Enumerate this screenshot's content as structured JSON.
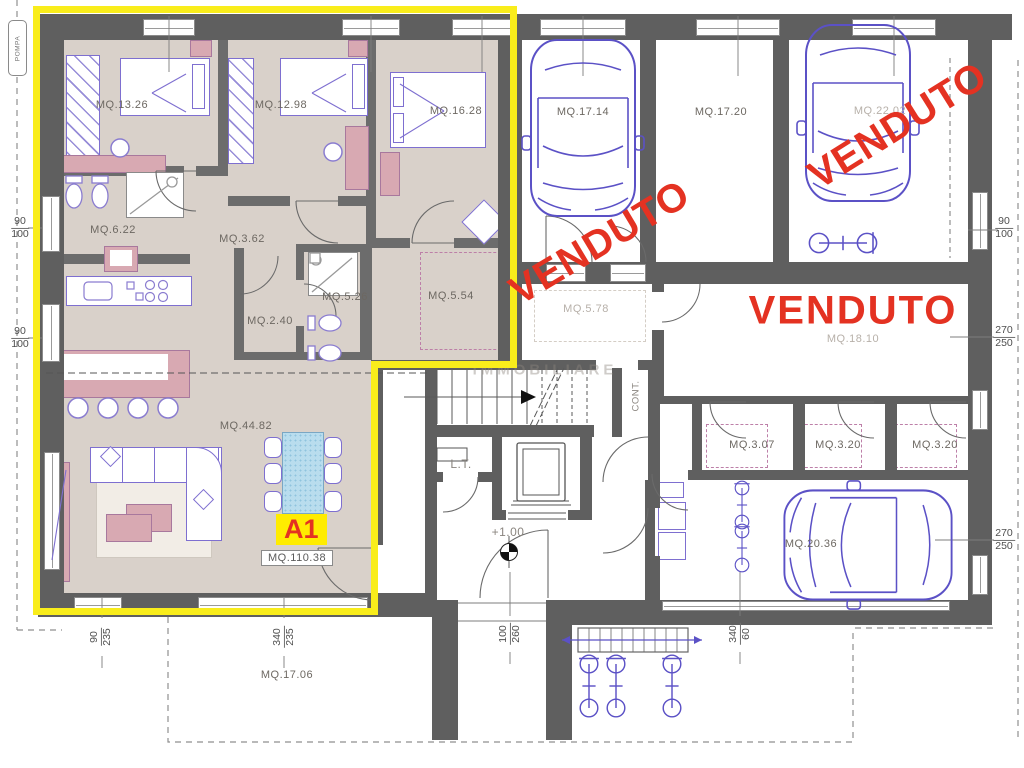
{
  "apartment": {
    "badge": "A1",
    "total_area": "MQ.110.38",
    "rooms": {
      "bedroom1": "MQ.13.26",
      "bedroom2": "MQ.12.98",
      "bedroom3": "MQ.16.28",
      "bathroom1": "MQ.6.22",
      "hallway": "MQ.3.62",
      "bathroom2": "MQ.5.26",
      "anteroom": "MQ.2.40",
      "closet": "MQ.5.54",
      "living": "MQ.44.82",
      "terrace": "MQ.17.06"
    }
  },
  "common_areas": {
    "corridor": "MQ.5.78",
    "lift": "L.T.",
    "level": "+1.00",
    "cont": "CONT.",
    "pompa": "POMPA"
  },
  "units": {
    "garage1": "MQ.17.14",
    "garage2": "MQ.17.20",
    "garage3": "MQ.22.02",
    "garage4": "MQ.20.36",
    "storeroom": "MQ.18.10",
    "cellar1": "MQ.3.07",
    "cellar2": "MQ.3.20",
    "cellar3": "MQ.3.20"
  },
  "sold_label": "VENDUTO",
  "watermark": "IMMOBILIARE",
  "dimensions": {
    "left_upper": {
      "a": "90",
      "b": "100"
    },
    "left_lower": {
      "a": "90",
      "b": "100"
    },
    "right_upper": {
      "a": "90",
      "b": "100"
    },
    "right_mid": {
      "a": "270",
      "b": "250"
    },
    "right_lower": {
      "a": "270",
      "b": "250"
    },
    "bottom_window1": {
      "a": "90",
      "b": "235"
    },
    "bottom_window2": {
      "a": "340",
      "b": "235"
    },
    "entrance_door": {
      "a": "100",
      "b": "260"
    },
    "bottom_right": {
      "a": "340",
      "b": "60"
    }
  },
  "colors": {
    "highlight_yellow": "#f9ed1b",
    "sold_red": "#e43222",
    "wall_gray": "#5f5f5f",
    "floor_beige": "#d9d1ca",
    "furniture_pink": "#d8a9b2",
    "drawing_purple": "#5b51c6",
    "table_blue": "#b9ddee"
  }
}
